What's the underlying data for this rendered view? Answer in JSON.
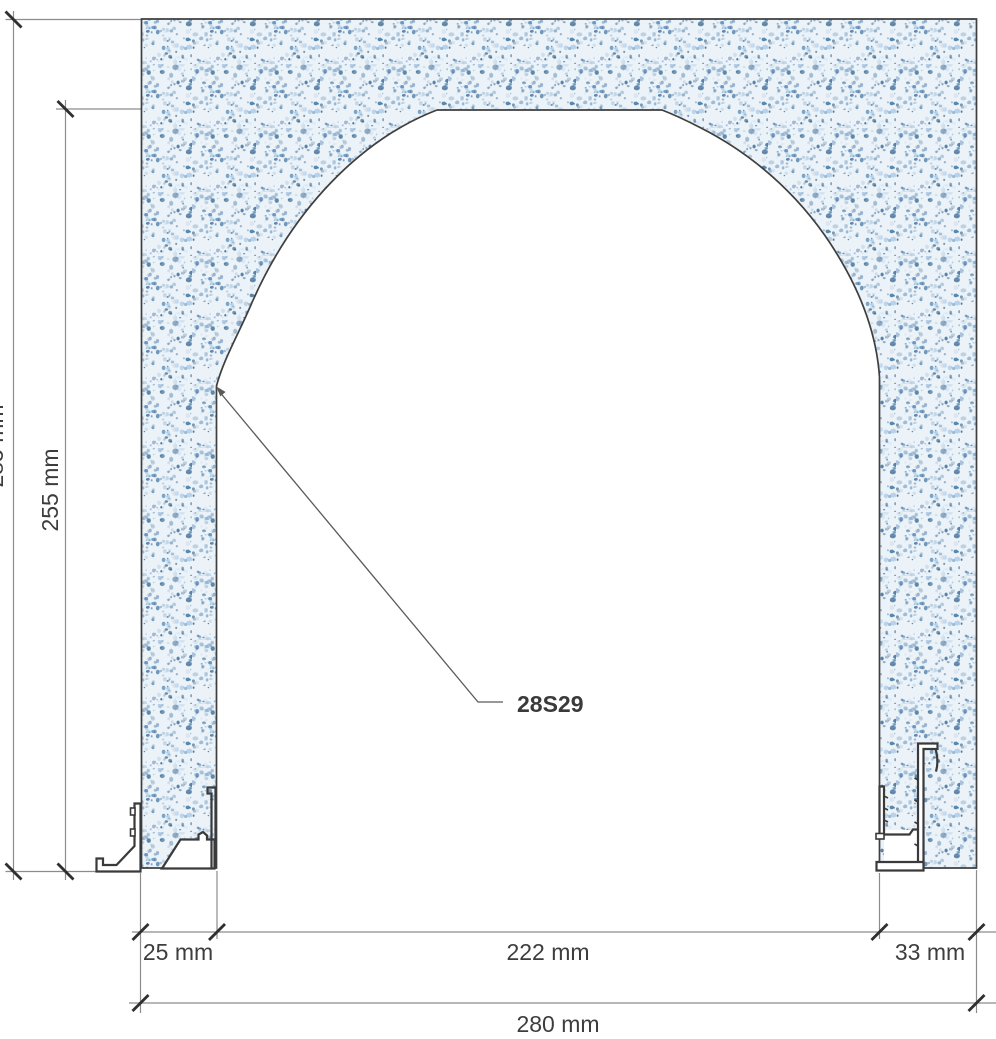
{
  "drawing": {
    "title": "arched-opening-section",
    "part_label": "28S29",
    "dimensions": {
      "overall_height": "285 mm",
      "opening_height": "255 mm",
      "left_jamb_width": "25 mm",
      "opening_width": "222 mm",
      "right_jamb_width": "33 mm",
      "overall_width": "280 mm"
    },
    "colors": {
      "material_base": "#ebf2f8",
      "speckle_blue": "#7fa6c9",
      "outline": "#3f3f3f",
      "dimension_line": "#8c8c8c",
      "label_text": "#3d3d3d"
    }
  }
}
